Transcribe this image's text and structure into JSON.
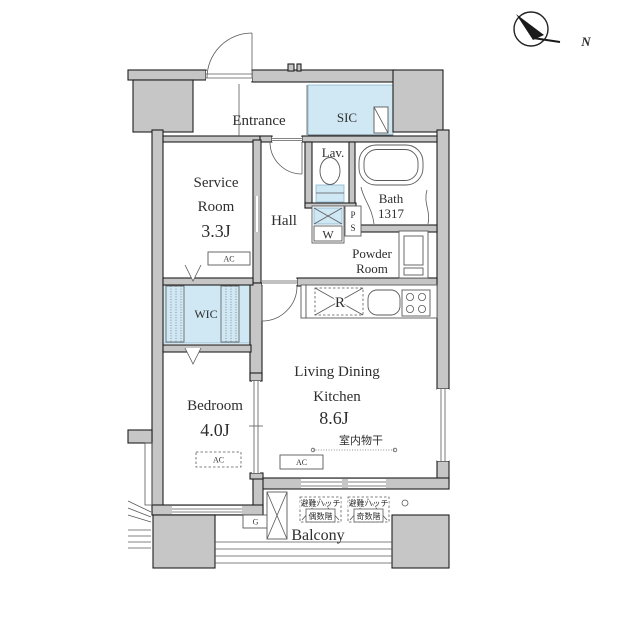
{
  "compass": {
    "north": "N"
  },
  "rooms": {
    "entrance": {
      "label": "Entrance"
    },
    "sic": {
      "label": "SIC"
    },
    "service_room": {
      "line1": "Service",
      "line2": "Room",
      "size": "3.3J"
    },
    "hall": {
      "label": "Hall"
    },
    "lavatory": {
      "label": "Lav."
    },
    "bath": {
      "label": "Bath",
      "size": "1317"
    },
    "powder_room": {
      "line1": "Powder",
      "line2": "Room"
    },
    "wic": {
      "label": "WIC"
    },
    "bedroom": {
      "label": "Bedroom",
      "size": "4.0J"
    },
    "ldk": {
      "line1": "Living Dining",
      "line2": "Kitchen",
      "size": "8.6J"
    },
    "balcony": {
      "label": "Balcony"
    }
  },
  "labels": {
    "ac": "AC",
    "washer": "W",
    "pipe_space_p": "P",
    "pipe_space_s": "S",
    "refrigerator": "R",
    "gas": "G",
    "indoor_drying": "室内物干",
    "hatch_even_line1": "避難ハッチ",
    "hatch_even_line2": "偶数階",
    "hatch_odd_line1": "避難ハッチ",
    "hatch_odd_line2": "奇数階"
  },
  "colors": {
    "wall_fill": "#c6c6c6",
    "closet_fill": "#cfe8f4",
    "outline": "#1e1e1e"
  }
}
